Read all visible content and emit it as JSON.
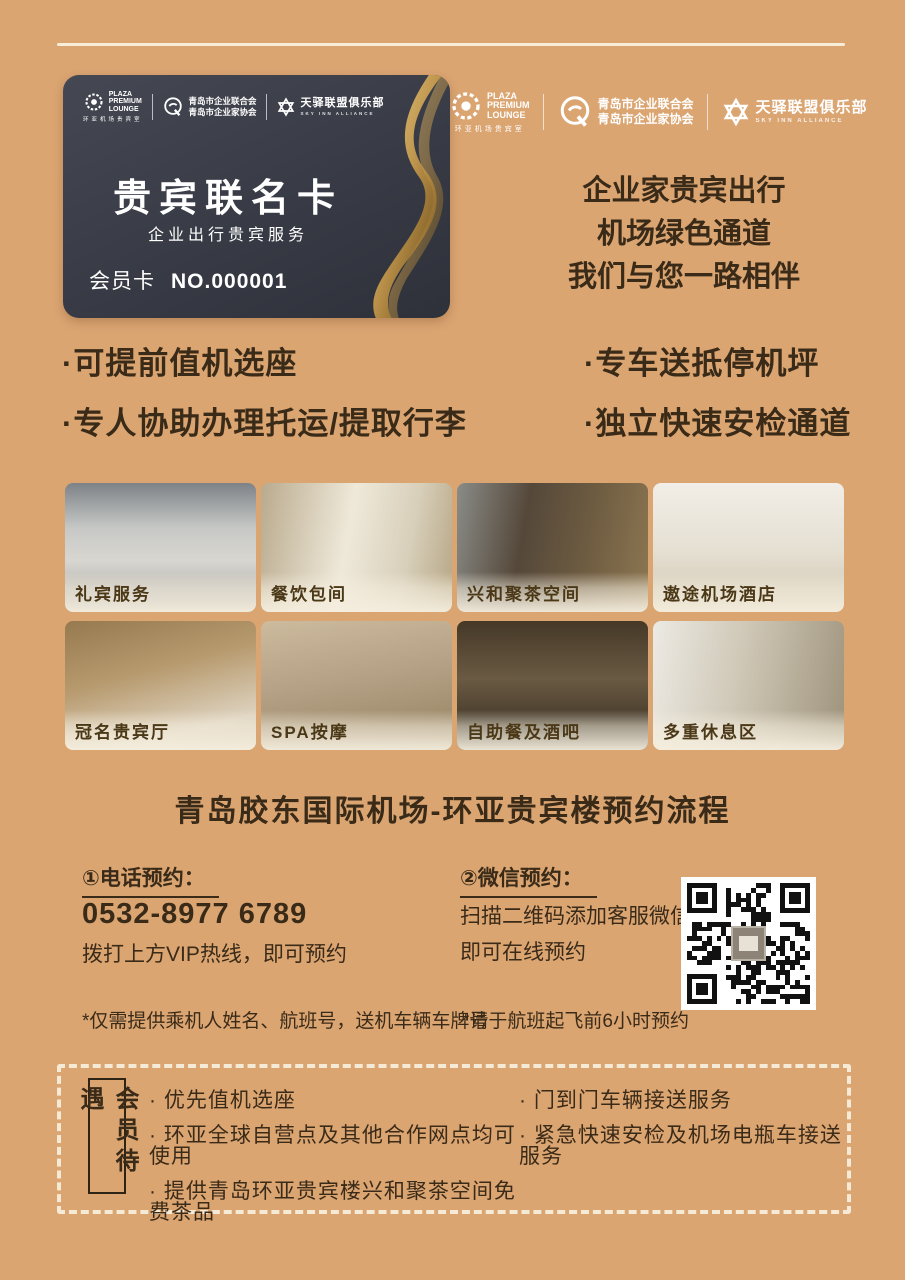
{
  "colors": {
    "background": "#dba572",
    "card_bg": "#383b45",
    "gold": "#c9a054",
    "text": "#3a2a18",
    "cream_line": "#f7eed9"
  },
  "partner_logos": [
    {
      "en1": "PLAZA",
      "en2": "PREMIUM",
      "en3": "LOUNGE",
      "cn": "环亚机场贵宾室"
    },
    {
      "cn1": "青岛市企业联合会",
      "cn2": "青岛市企业家协会"
    },
    {
      "cn": "天驿联盟俱乐部",
      "en": "SKY INN ALLIANCE"
    }
  ],
  "card": {
    "title": "贵宾联名卡",
    "subtitle": "企业出行贵宾服务",
    "member_label": "会员卡",
    "member_no": "NO.000001"
  },
  "tagline": {
    "line1": "企业家贵宾出行",
    "line2": "机场绿色通道",
    "line3": "我们与您一路相伴"
  },
  "features": {
    "left": [
      "·可提前值机选座",
      "·专人协助办理托运/提取行李"
    ],
    "right": [
      "·专车送抵停机坪",
      "·独立快速安检通道"
    ]
  },
  "gallery": [
    {
      "label": "礼宾服务"
    },
    {
      "label": "餐饮包间"
    },
    {
      "label": "兴和聚茶空间"
    },
    {
      "label": "遨途机场酒店"
    },
    {
      "label": "冠名贵宾厅"
    },
    {
      "label": "SPA按摩"
    },
    {
      "label": "自助餐及酒吧"
    },
    {
      "label": "多重休息区"
    }
  ],
  "booking": {
    "section_title": "青岛胶东国际机场-环亚贵宾楼预约流程",
    "phone": {
      "heading": "①电话预约：",
      "number": "0532-8977 6789",
      "note": "拨打上方VIP热线，即可预约"
    },
    "wechat": {
      "heading": "②微信预约：",
      "line1": "扫描二维码添加客服微信",
      "line2": "即可在线预约"
    },
    "footnote_left": "*仅需提供乘机人姓名、航班号，送机车辆车牌号",
    "footnote_right": "*请于航班起飞前6小时预约"
  },
  "benefits": {
    "label": "会员待遇",
    "left": [
      "· 优先值机选座",
      "· 环亚全球自营点及其他合作网点均可使用",
      "· 提供青岛环亚贵宾楼兴和聚茶空间免费茶品"
    ],
    "right": [
      "· 门到门车辆接送服务",
      "· 紧急快速安检及机场电瓶车接送服务"
    ]
  }
}
